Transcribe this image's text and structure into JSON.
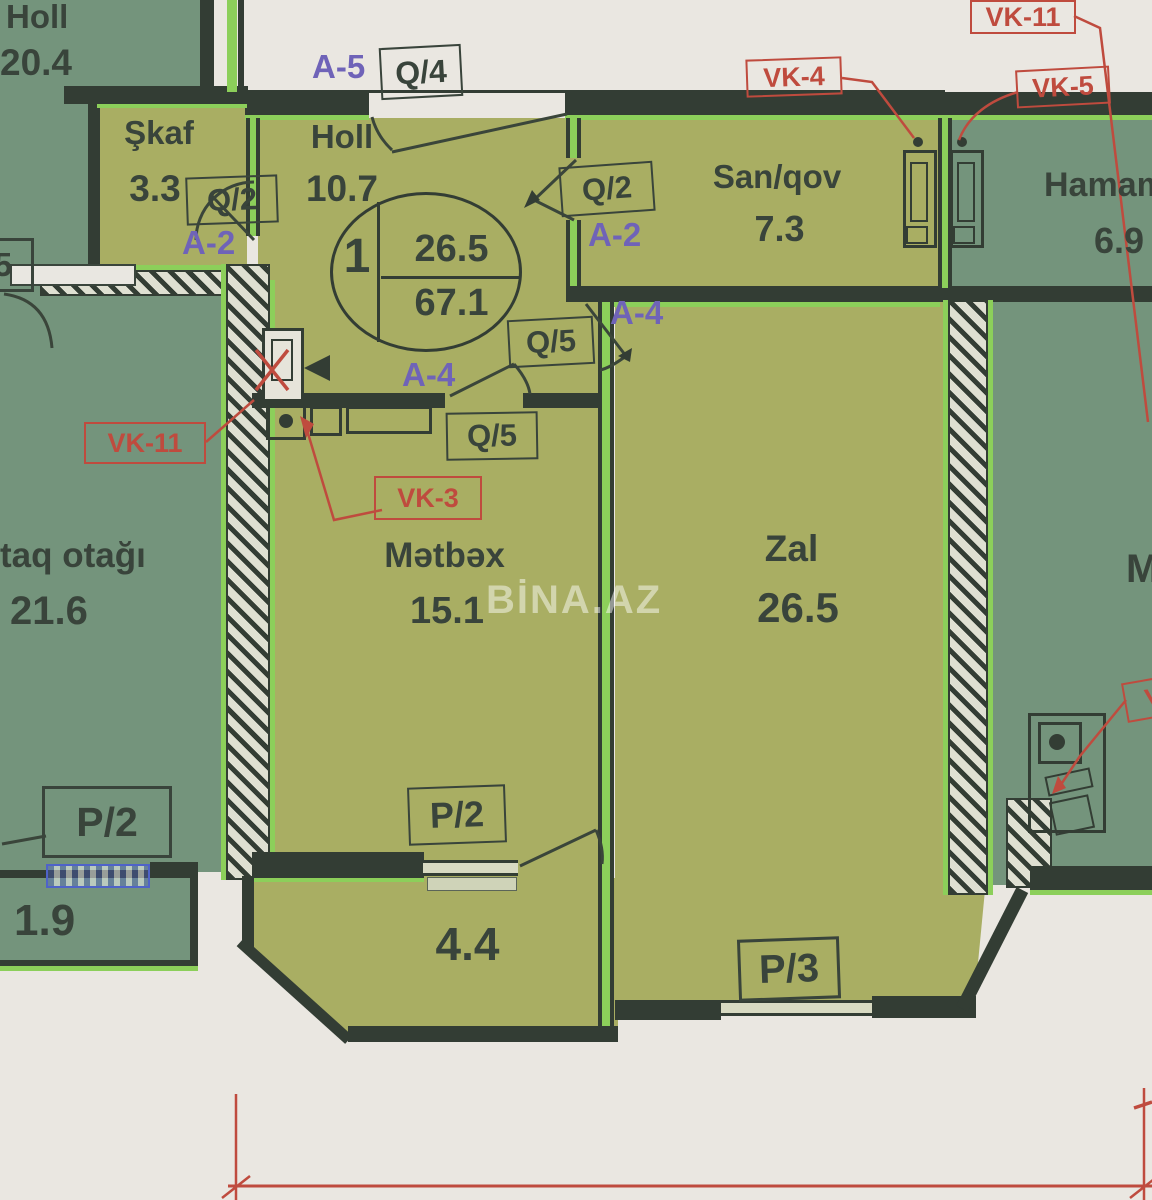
{
  "watermark": "BİNA.AZ",
  "stamp": {
    "unit": "1",
    "upper": "26.5",
    "lower": "67.1"
  },
  "rooms": {
    "neighbor_holl": {
      "name": "Holl",
      "area": "20.4"
    },
    "shkaf": {
      "name": "Şkaf",
      "area": "3.3"
    },
    "holl": {
      "name": "Holl",
      "area": "10.7"
    },
    "sanqov": {
      "name": "San/qov",
      "area": "7.3"
    },
    "hamam": {
      "name": "Hamam",
      "area": "6.9"
    },
    "yataq_otagi": {
      "name": "taq otağı",
      "area": "21.6"
    },
    "metbex": {
      "name": "Mətbəx",
      "area": "15.1"
    },
    "zal": {
      "name": "Zal",
      "area": "26.5"
    },
    "balcony_left": {
      "area": "1.9"
    },
    "balcony_kitchen": {
      "area": "4.4"
    },
    "neighbor_partial": {
      "name": "M"
    }
  },
  "door_tags": {
    "q4": "Q/4",
    "q2_shkaf": "Q/2",
    "q2_sanqov": "Q/2",
    "q5_hall": "Q/5",
    "q5_kitchen": "Q/5",
    "p2_left": "P/2",
    "p2_kitchen": "P/2",
    "p3_zal": "P/3",
    "edge_partial": "5"
  },
  "axis_tags": {
    "a5": "A-5",
    "a2_shkaf": "A-2",
    "a2_sanqov": "A-2",
    "a4_zal": "A-4",
    "a4_kitchen": "A-4"
  },
  "vent_tags": {
    "vk11_top": "VK-11",
    "vk4": "VK-4",
    "vk5": "VK-5",
    "vk11_left": "VK-11",
    "vk3": "VK-3",
    "vk_partial": "V"
  },
  "colors": {
    "apartment_fill": "#a9ae63",
    "neighbor_fill": "#74947c",
    "wall": "#333d34",
    "highlight_green": "#8ccf5a",
    "annotation_red": "#bf4b3e",
    "axis_purple": "#6f63b8",
    "paper": "#eae7e1",
    "radiator_blue": "#4f63c9"
  }
}
